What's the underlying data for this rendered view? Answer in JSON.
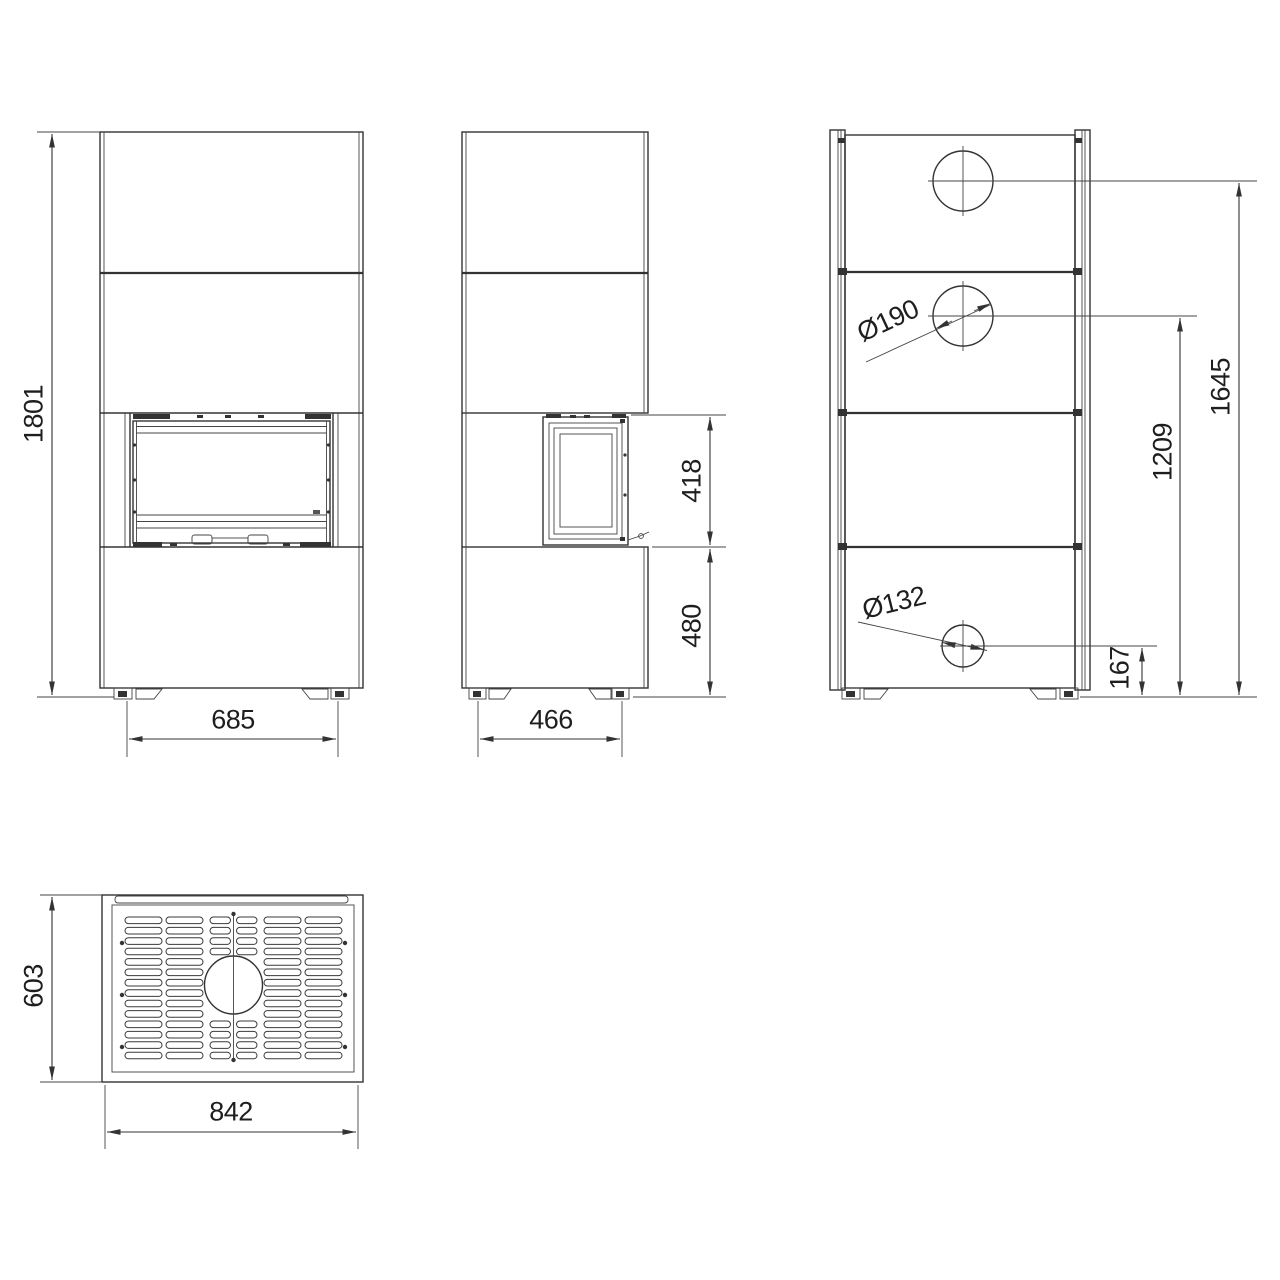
{
  "drawing": {
    "title": "stove-technical-drawing",
    "background": "#ffffff",
    "line_color": "#333333",
    "views": {
      "front": "front-view",
      "side": "side-view",
      "rear": "rear-view",
      "top": "top-view"
    },
    "dimensions": {
      "overall_height": "1801",
      "front_feet_spacing": "685",
      "firebox_height": "418",
      "base_height": "480",
      "side_feet_spacing": "466",
      "top_flue_diameter": "Ø190",
      "rear_flue_diameter": "Ø132",
      "top_flue_center_height": "1645",
      "rear_flue_upper_center_height": "1209",
      "rear_flue_lower_center_height": "167",
      "top_depth": "603",
      "top_width": "842"
    }
  }
}
